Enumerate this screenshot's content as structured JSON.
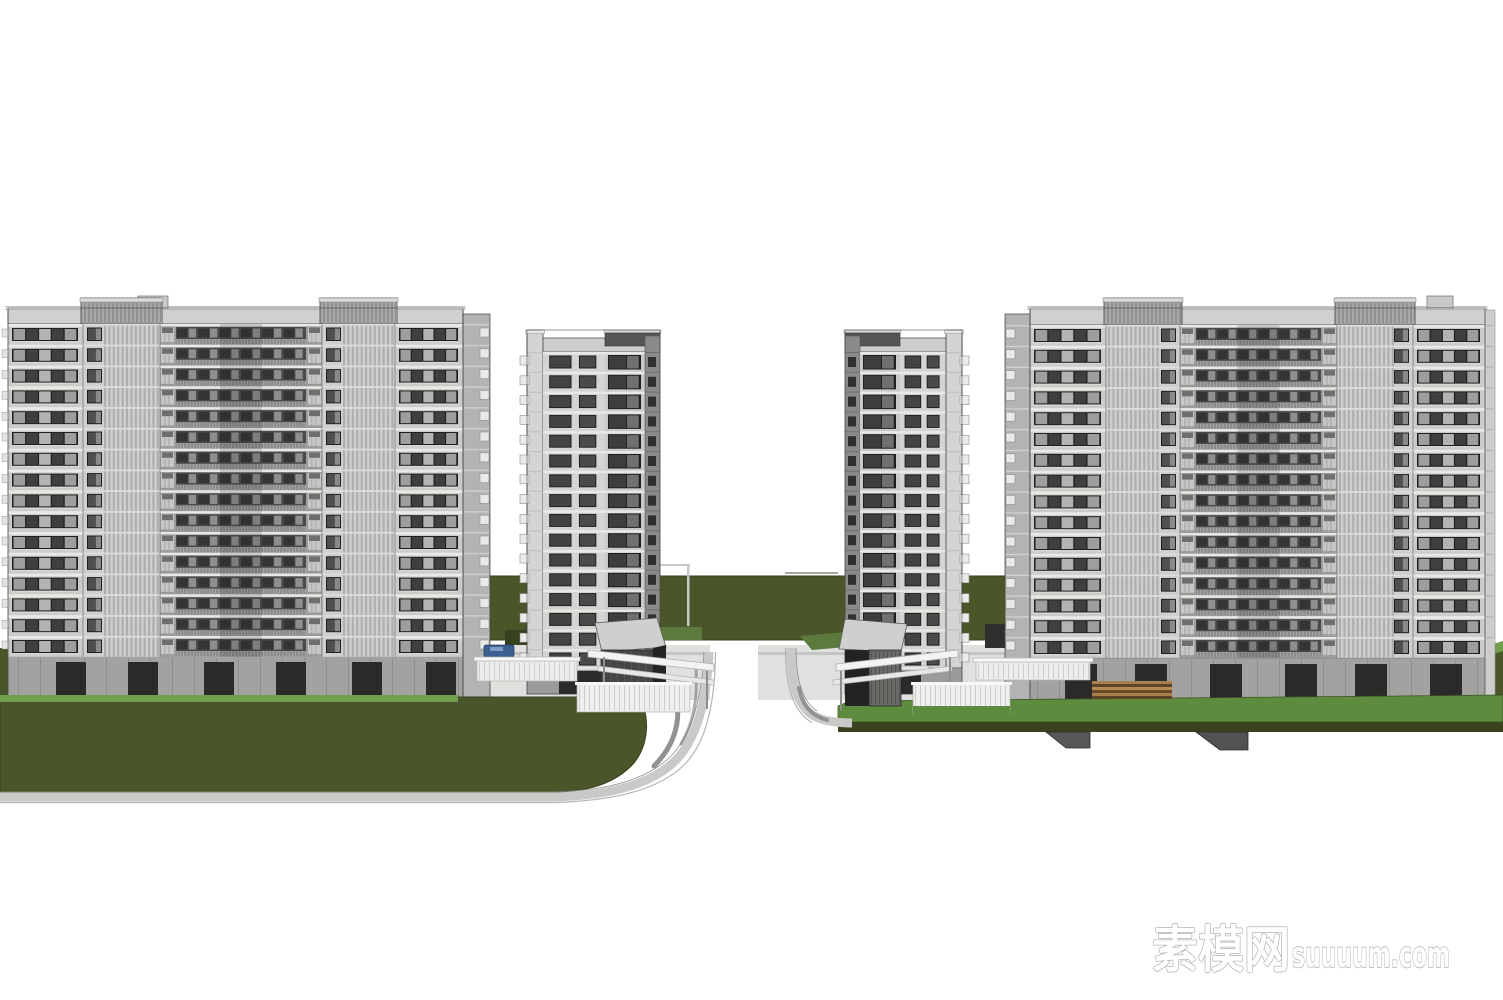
{
  "watermark": {
    "zh": "素模网",
    "en": "suuuum.com",
    "outline_color": "#adadab",
    "fill_color": "#ffffff"
  },
  "palette": {
    "background": "#ffffff",
    "facade_light": "#d6d6d4",
    "facade": "#cbcbc9",
    "facade_mid": "#b9b9b7",
    "stripe_light": "#cfcfcd",
    "stripe_dark": "#aeaeac",
    "slab_line": "#e8e8e6",
    "window_frame": "#1f1f1d",
    "glass_dark": "#3f3f3d",
    "glass_mid": "#8f8f8d",
    "pane_light": "#a7a7a5",
    "parapet": "#d0d0ce",
    "cap_dark": "#565654",
    "mid_band": "#4a4a48",
    "railing": "#9a9a98",
    "balcony": "#c6c6c4",
    "ground_floor": "#a2a2a0",
    "opening": "#2a2a28",
    "olive": "#4a5529",
    "olive_face": "#3a431f",
    "grass_bright": "#5d8c3e",
    "hedge_bright": "#6f9e4d",
    "road": "#c9c9c7",
    "white_struct": "#f3f3f1",
    "outline": "#3f3f3d"
  },
  "scene": {
    "canvas": {
      "w": 1503,
      "h": 1000
    },
    "background_layer": [
      {
        "n": "rear-lawn-band",
        "k": "rect",
        "x": 452,
        "y": 576,
        "w": 560,
        "h": 64,
        "f": "#4a5529",
        "s": "#39411f",
        "sw": 1
      },
      {
        "n": "rear-lawn-sliver-left",
        "k": "rect",
        "x": 0,
        "y": 648,
        "w": 10,
        "h": 50,
        "f": "#4a5529"
      },
      {
        "n": "rear-lawn-sliver-right",
        "k": "poly",
        "p": "1487,646 1503,641 1503,702 1487,702",
        "f": "#4a5529"
      },
      {
        "n": "rear-sliver-highlight",
        "k": "poly",
        "p": "1487,646 1503,641 1503,651 1487,656",
        "f": "#6f9e4d"
      },
      {
        "n": "goal-frame-bar",
        "k": "rect",
        "x": 648,
        "y": 564,
        "w": 42,
        "h": 2,
        "f": "#c8c8c6"
      },
      {
        "n": "goal-frame-post",
        "k": "rect",
        "x": 687,
        "y": 564,
        "w": 2.5,
        "h": 62,
        "f": "#c8c8c6"
      },
      {
        "n": "center-rail-line",
        "k": "rect",
        "x": 785,
        "y": 572,
        "w": 53,
        "h": 2,
        "f": "#a5a5a3"
      },
      {
        "n": "left-gate-plaza",
        "k": "rect",
        "x": 452,
        "y": 645,
        "w": 258,
        "h": 55,
        "f": "#e0e0de"
      },
      {
        "n": "right-gate-plaza",
        "k": "rect",
        "x": 758,
        "y": 645,
        "w": 254,
        "h": 55,
        "f": "#e0e0de"
      },
      {
        "n": "plaza-stripe-left",
        "k": "rect",
        "x": 452,
        "y": 652,
        "w": 258,
        "h": 3,
        "f": "#c4c4c2"
      },
      {
        "n": "plaza-stripe-right",
        "k": "rect",
        "x": 758,
        "y": 652,
        "w": 254,
        "h": 3,
        "f": "#c4c4c2"
      },
      {
        "n": "hedge-behind-left-gate",
        "k": "rect",
        "x": 656,
        "y": 627,
        "w": 46,
        "h": 13,
        "f": "#5c7a3e"
      },
      {
        "n": "dark-hedge-left",
        "k": "rect",
        "x": 505,
        "y": 630,
        "w": 38,
        "h": 15,
        "f": "#36411f"
      },
      {
        "n": "hedge-wedge-right",
        "k": "poly",
        "p": "800,636 846,632 858,646 812,650",
        "f": "#5c7a3e"
      },
      {
        "n": "dark-hedge-right",
        "k": "rect",
        "x": 985,
        "y": 624,
        "w": 28,
        "h": 24,
        "f": "#2f2f2d"
      }
    ],
    "terrain_layer": [
      {
        "n": "left-front-lawn",
        "k": "path",
        "d": "M0,697 L640,697 C650,718 649,744 634,763 C616,783 590,791 558,792 L0,792 Z",
        "f": "#4a5529",
        "s": "#39411f",
        "sw": 1
      },
      {
        "n": "left-hedge-strip",
        "k": "rect",
        "x": 0,
        "y": 695,
        "w": 458,
        "h": 7,
        "f": "#6f9e4d"
      },
      {
        "n": "left-road",
        "k": "path",
        "d": "M0,797 L556,797 C612,795 652,784 676,760 C697,738 707,700 709,652",
        "s": "#c9c9c7",
        "sw": 9
      },
      {
        "n": "left-road-outer-edge",
        "k": "path",
        "d": "M0,802.5 L558,802.5 C620,800 662,788 686,763 C707,740 715,702 715.5,652",
        "s": "#b5b5b3",
        "sw": 1.2
      },
      {
        "n": "left-road-inner-edge",
        "k": "path",
        "d": "M0,792 L556,792 C610,790 648,779 671,756 C692,734 702,698 704,652",
        "s": "#8e8e8c",
        "sw": 0.8
      },
      {
        "n": "left-road-shadow-1",
        "k": "path",
        "d": "M676,698 C682,724 672,748 654,766",
        "s": "#6e6e6c",
        "sw": 5,
        "o": 0.75,
        "lc": "round"
      },
      {
        "n": "left-road-shadow-2",
        "k": "path",
        "d": "M696,668 C698,700 693,724 681,744",
        "s": "#6e6e6c",
        "sw": 3,
        "o": 0.55,
        "lc": "round"
      },
      {
        "n": "right-lawn-top",
        "k": "poly",
        "p": "838,722 838,706 850,701 1503,695 1503,722",
        "f": "#5d8c3e",
        "s": "#3d5024",
        "sw": 0.8
      },
      {
        "n": "right-lawn-face",
        "k": "rect",
        "x": 838,
        "y": 722,
        "w": 665,
        "h": 10,
        "f": "#3a431f"
      },
      {
        "n": "right-lawn-pier-1",
        "k": "poly",
        "p": "1046,732 1090,732 1090,748 1066,748",
        "f": "#575755",
        "s": "#2c2c2a",
        "sw": 0.8
      },
      {
        "n": "right-lawn-pier-2",
        "k": "poly",
        "p": "1196,732 1248,732 1248,750 1220,750",
        "f": "#525250",
        "s": "#2c2c2a",
        "sw": 0.8
      },
      {
        "n": "right-road",
        "k": "path",
        "d": "M791,648 C791,682 797,706 814,716 C826,722 840,723 852,723",
        "s": "#c9c9c7",
        "sw": 9
      },
      {
        "n": "right-road-outer-edge",
        "k": "path",
        "d": "M785.5,648 C785.5,686 793,712 812,722.5",
        "s": "#b5b5b3",
        "sw": 1.2
      },
      {
        "n": "right-road-inner-edge",
        "k": "path",
        "d": "M796,648 C796,680 802,701 817,711",
        "s": "#8e8e8c",
        "sw": 0.8
      },
      {
        "n": "right-road-shadow",
        "k": "path",
        "d": "M799,688 C803,708 813,716 827,720",
        "s": "#6e6e6c",
        "sw": 4,
        "o": 0.6,
        "lc": "round"
      }
    ],
    "slabs": [
      {
        "name": "left-apartment-slab",
        "x": 8,
        "parapet_top": 308,
        "core_top": 298,
        "floor_top": 324,
        "floor_h": 20.8,
        "floors": 16,
        "sections": [
          {
            "t": "wing",
            "w": 75
          },
          {
            "t": "core",
            "w": 77,
            "win": "left"
          },
          {
            "t": "mid",
            "w": 162
          },
          {
            "t": "core",
            "w": 73,
            "win": "left"
          },
          {
            "t": "wing",
            "w": 68
          }
        ],
        "side_return": {
          "side": "right",
          "w": 27
        },
        "edge_tabs": "left",
        "roof_boxes": [
          {
            "dx": 130,
            "w": 30
          }
        ],
        "ground": {
          "x": 8,
          "w": 482,
          "top": 656,
          "bottom": 700,
          "openings": [
            48,
            120,
            196,
            268,
            344,
            418
          ],
          "opening_w": 30
        }
      },
      {
        "name": "right-apartment-slab",
        "x": 1030,
        "parapet_top": 308,
        "core_top": 298,
        "floor_top": 325,
        "floor_h": 20.8,
        "floors": 16,
        "sections": [
          {
            "t": "wing",
            "w": 76
          },
          {
            "t": "core",
            "w": 74,
            "win": "right"
          },
          {
            "t": "mid",
            "w": 157
          },
          {
            "t": "core",
            "w": 76,
            "win": "right"
          },
          {
            "t": "wing",
            "w": 72
          }
        ],
        "side_return": {
          "side": "left",
          "w": 25
        },
        "side_face": {
          "x": 1485,
          "w": 10
        },
        "roof_boxes": [
          {
            "dx": 397,
            "w": 26
          }
        ],
        "ground": {
          "x": 1005,
          "w": 490,
          "top": 658,
          "bottom": 703,
          "openings": [
            60,
            130,
            205,
            280,
            350,
            425
          ],
          "opening_w": 32
        }
      }
    ],
    "towers": [
      {
        "name": "left-slim-tower",
        "x": 527,
        "cap_top": 330,
        "floor_top": 352,
        "floor_h": 19.8,
        "floors": 16,
        "parts": [
          {
            "t": "pylon",
            "w": 16,
            "tabs": "left"
          },
          {
            "t": "winCols",
            "w": 62
          },
          {
            "t": "bigWin",
            "w": 40
          },
          {
            "t": "darkEdge",
            "w": 15
          }
        ],
        "cap_dark": {
          "from": 78,
          "to": 133
        },
        "ground": {
          "top": 668,
          "bottom": 694,
          "entrance_dx": 32,
          "entrance_w": 42
        }
      },
      {
        "name": "right-slim-tower",
        "x": 845,
        "cap_top": 330,
        "floor_top": 352,
        "floor_h": 19.8,
        "floors": 16,
        "parts": [
          {
            "t": "darkEdge",
            "w": 15
          },
          {
            "t": "bigWin",
            "w": 40
          },
          {
            "t": "winCols",
            "w": 46
          },
          {
            "t": "pylon",
            "w": 16,
            "tabs": "right"
          }
        ],
        "cap_dark": {
          "from": 0,
          "to": 55
        },
        "ground": {
          "top": 668,
          "bottom": 694,
          "entrance_dx": 38,
          "entrance_w": 38
        }
      }
    ],
    "gates": {
      "left": [
        {
          "n": "parked-car",
          "k": "rect",
          "x": 484,
          "y": 645,
          "w": 30,
          "h": 12,
          "f": "#3c5f92",
          "s": "#24406b",
          "sw": 0.8,
          "rx": 2
        },
        {
          "n": "parked-car-window",
          "k": "rect",
          "x": 490,
          "y": 647,
          "w": 13,
          "h": 4,
          "f": "#7f9cc4"
        },
        {
          "n": "entry-wall-left",
          "k": "rect",
          "x": 477,
          "y": 661,
          "w": 100,
          "h": 20,
          "f": "#ededeb",
          "s": "#b5b5b3",
          "sw": 0.7,
          "slats": 5
        },
        {
          "n": "entry-wall-left-cap",
          "k": "rect",
          "x": 474,
          "y": 657,
          "w": 106,
          "h": 4,
          "f": "#f6f6f4",
          "s": "#b5b5b3",
          "sw": 0.7
        },
        {
          "n": "gate-cube-top",
          "k": "poly",
          "p": "595,623 657,618 666,647 602,652",
          "f": "#cfcfcd",
          "s": "#5a5a58",
          "sw": 0.8
        },
        {
          "n": "gate-cube-front",
          "k": "rect",
          "x": 601,
          "y": 650,
          "w": 52,
          "h": 57,
          "f": "#454543",
          "s": "#2a2a28",
          "sw": 0.8,
          "slats": 7,
          "slatColor": "#575755"
        },
        {
          "n": "gate-cube-side",
          "k": "poly",
          "p": "653,648 666,645 666,692 653,705",
          "f": "#232321"
        },
        {
          "n": "gate-canopy-upper",
          "k": "poly",
          "p": "588,650 714,664 714,671 588,657",
          "f": "#f3f3f1",
          "s": "#b0b0ae",
          "sw": 0.8
        },
        {
          "n": "gate-canopy-lower",
          "k": "poly",
          "p": "598,666 714,680 714,685 598,671",
          "f": "#e7e7e5",
          "s": "#b0b0ae",
          "sw": 0.7
        },
        {
          "n": "gate-post-1",
          "k": "rect",
          "x": 603,
          "y": 657,
          "w": 2,
          "h": 46,
          "f": "#8e8e8c"
        },
        {
          "n": "gate-post-2",
          "k": "rect",
          "x": 706,
          "y": 671,
          "w": 2,
          "h": 38,
          "f": "#8e8e8c"
        },
        {
          "n": "gate-fence",
          "k": "rect",
          "x": 577,
          "y": 684,
          "w": 113,
          "h": 28,
          "f": "#efefed",
          "s": "#b0b0ae",
          "sw": 0.7,
          "slats": 5
        },
        {
          "n": "gate-fence-cap",
          "k": "rect",
          "x": 575,
          "y": 682,
          "w": 117,
          "h": 3,
          "f": "#f8f8f6"
        }
      ],
      "right": [
        {
          "n": "deck-stripe-1",
          "k": "rect",
          "x": 1092,
          "y": 681,
          "w": 80,
          "h": 3,
          "f": "#a97f4e"
        },
        {
          "n": "deck-stripe-2",
          "k": "rect",
          "x": 1092,
          "y": 684,
          "w": 80,
          "h": 3,
          "f": "#5e4426"
        },
        {
          "n": "deck-stripe-3",
          "k": "rect",
          "x": 1092,
          "y": 687,
          "w": 80,
          "h": 3,
          "f": "#b98a55"
        },
        {
          "n": "deck-stripe-4",
          "k": "rect",
          "x": 1092,
          "y": 690,
          "w": 80,
          "h": 3,
          "f": "#6a4a28"
        },
        {
          "n": "deck-stripe-5",
          "k": "rect",
          "x": 1092,
          "y": 693,
          "w": 80,
          "h": 3,
          "f": "#a97f4e"
        },
        {
          "n": "deck-stripe-6",
          "k": "rect",
          "x": 1092,
          "y": 696,
          "w": 80,
          "h": 3,
          "f": "#5e4426"
        },
        {
          "n": "entry-wall-right",
          "k": "rect",
          "x": 976,
          "y": 662,
          "w": 114,
          "h": 18,
          "f": "#ededeb",
          "s": "#b5b5b3",
          "sw": 0.7,
          "slats": 5
        },
        {
          "n": "entry-wall-right-cap",
          "k": "rect",
          "x": 973,
          "y": 658,
          "w": 120,
          "h": 4,
          "f": "#f6f6f4",
          "s": "#b5b5b3",
          "sw": 0.7
        },
        {
          "n": "gate-cube-top",
          "k": "poly",
          "p": "845,619 907,624 901,652 839,649",
          "f": "#cfcfcd",
          "s": "#5a5a58",
          "sw": 0.8
        },
        {
          "n": "gate-cube-front",
          "k": "rect",
          "x": 845,
          "y": 650,
          "w": 24,
          "h": 56,
          "f": "#232321"
        },
        {
          "n": "gate-cube-slatted",
          "k": "rect",
          "x": 869,
          "y": 650,
          "w": 32,
          "h": 56,
          "f": "#6a6a68",
          "s": "#2a2a28",
          "sw": 0.8,
          "slats": 4,
          "slatColor": "#4f4f4d"
        },
        {
          "n": "gate-canopy-upper",
          "k": "poly",
          "p": "836,664 958,650 958,657 836,671",
          "f": "#f3f3f1",
          "s": "#b0b0ae",
          "sw": 0.8
        },
        {
          "n": "gate-canopy-lower",
          "k": "poly",
          "p": "833,680 952,666 952,671 833,685",
          "f": "#e7e7e5",
          "s": "#b0b0ae",
          "sw": 0.7
        },
        {
          "n": "gate-post-1",
          "k": "rect",
          "x": 840,
          "y": 671,
          "w": 2,
          "h": 40,
          "f": "#8e8e8c"
        },
        {
          "n": "gate-post-2",
          "k": "rect",
          "x": 949,
          "y": 657,
          "w": 2,
          "h": 44,
          "f": "#8e8e8c"
        },
        {
          "n": "gate-fence",
          "k": "rect",
          "x": 913,
          "y": 684,
          "w": 97,
          "h": 30,
          "f": "#efefed",
          "s": "#b0b0ae",
          "sw": 0.7,
          "slats": 5
        },
        {
          "n": "gate-fence-cap",
          "k": "rect",
          "x": 911,
          "y": 682,
          "w": 101,
          "h": 3,
          "f": "#f8f8f6"
        },
        {
          "n": "fence-hedge",
          "k": "rect",
          "x": 913,
          "y": 706,
          "w": 97,
          "h": 9,
          "f": "#5d8c3e"
        }
      ]
    }
  }
}
